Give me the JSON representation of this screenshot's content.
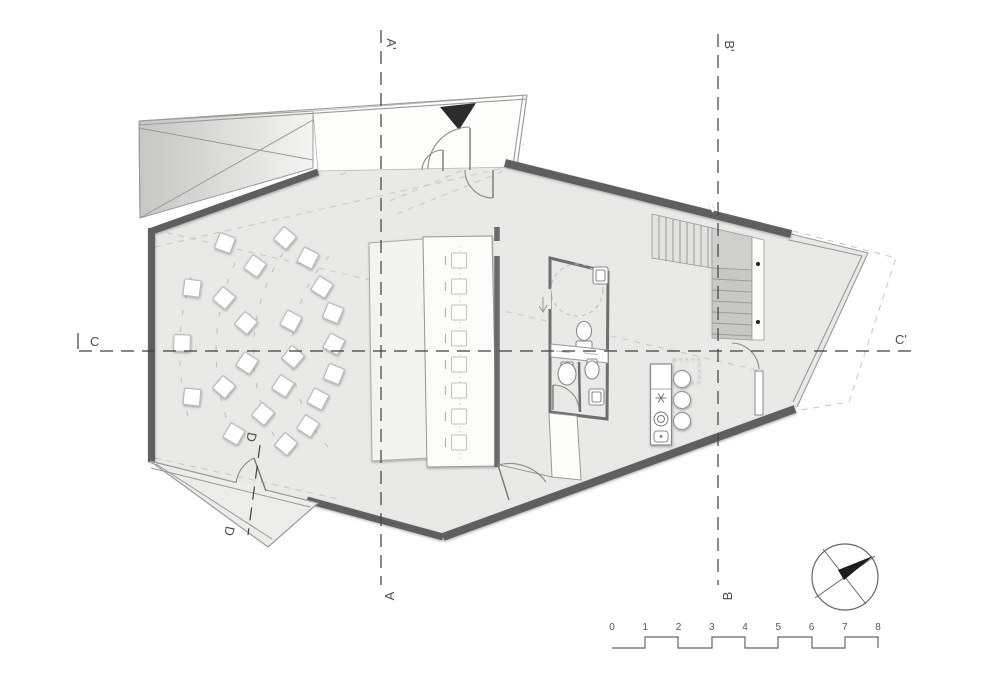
{
  "plan": {
    "type": "architectural-floor-plan",
    "sections": {
      "a_top": "A'",
      "a_bottom": "A",
      "b_top": "B'",
      "b_bottom": "B",
      "c_left": "C",
      "c_right": "C'",
      "d_upper": "D",
      "d_lower": "D"
    },
    "scale_bar": {
      "ticks": [
        "0",
        "1",
        "2",
        "3",
        "4",
        "5",
        "6",
        "7",
        "8"
      ],
      "x0": 612,
      "unit": 33.25,
      "num_y": 630
    },
    "chairs": [
      [
        225,
        243,
        20
      ],
      [
        285,
        238,
        40
      ],
      [
        308,
        258,
        28
      ],
      [
        255,
        266,
        35
      ],
      [
        192,
        288,
        8
      ],
      [
        224,
        298,
        40
      ],
      [
        322,
        287,
        32
      ],
      [
        333,
        313,
        22
      ],
      [
        246,
        323,
        40
      ],
      [
        291,
        321,
        28
      ],
      [
        182,
        343,
        2
      ],
      [
        247,
        363,
        33
      ],
      [
        293,
        357,
        40
      ],
      [
        334,
        344,
        28
      ],
      [
        334,
        374,
        22
      ],
      [
        224,
        387,
        40
      ],
      [
        192,
        397,
        6
      ],
      [
        283,
        386,
        33
      ],
      [
        318,
        399,
        28
      ],
      [
        263,
        414,
        40
      ],
      [
        234,
        434,
        30
      ],
      [
        308,
        426,
        33
      ],
      [
        286,
        444,
        40
      ]
    ],
    "table_seats_y": [
      253,
      279,
      305,
      331,
      357,
      383,
      409,
      435
    ],
    "stools": [
      [
        682,
        379
      ],
      [
        682,
        400
      ],
      [
        682,
        421
      ]
    ],
    "colors": {
      "floor": "#e9e9e7",
      "wall": "#5e5e5e",
      "section_line": "#3f3f3f",
      "faint_line": "#c9c9c6",
      "fixture_line": "#8a8a88",
      "needle": "#1d1d1d"
    }
  }
}
